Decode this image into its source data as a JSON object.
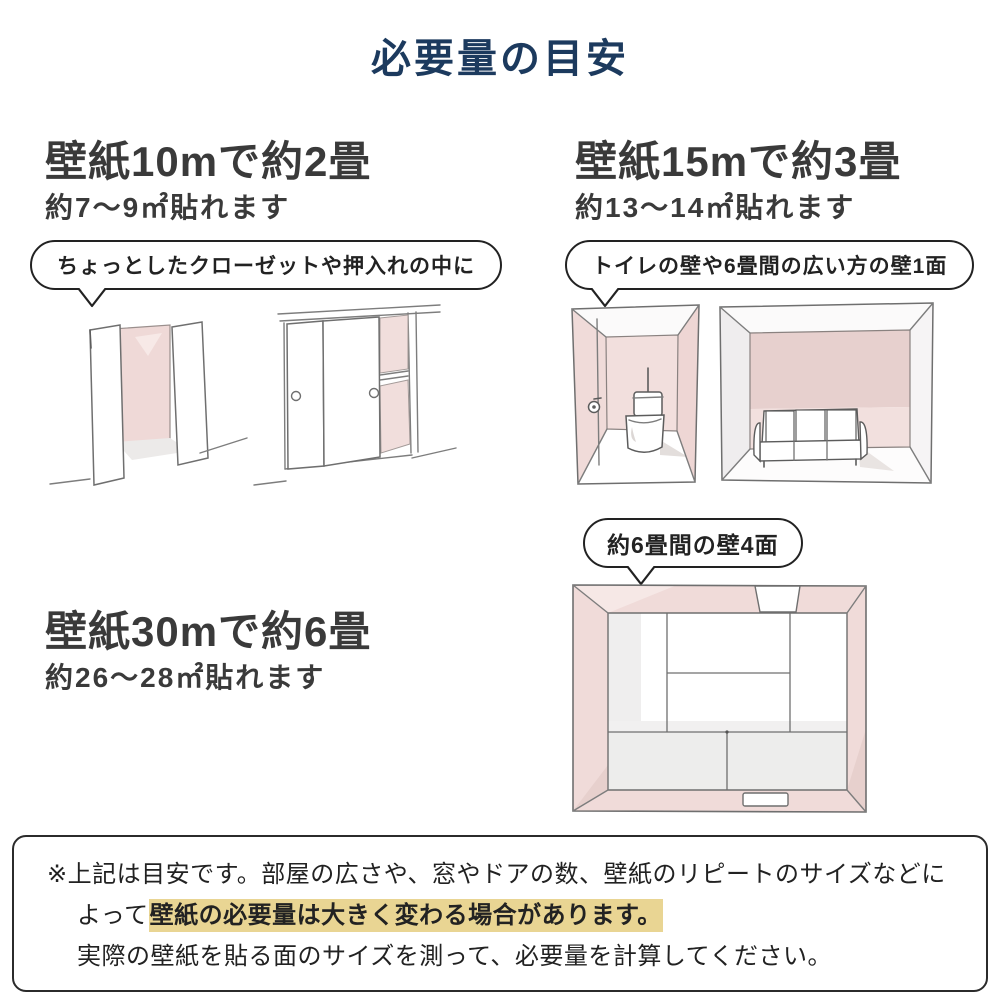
{
  "title": "必要量の目安",
  "sections": {
    "s10": {
      "heading": "壁紙10mで約2畳",
      "subheading": "約7〜9㎡貼れます",
      "bubble": "ちょっとしたクローゼットや押入れの中に",
      "illustrations": [
        "open-closet",
        "sliding-door-closet"
      ]
    },
    "s15": {
      "heading": "壁紙15mで約3畳",
      "subheading": "約13〜14㎡貼れます",
      "bubble": "トイレの壁や6畳間の広い方の壁1面",
      "illustrations": [
        "toilet-room",
        "sofa-room"
      ]
    },
    "s30": {
      "heading": "壁紙30mで約6畳",
      "subheading": "約26〜28㎡貼れます",
      "bubble": "約6畳間の壁4面",
      "illustrations": [
        "six-tatami-room-top-view"
      ]
    }
  },
  "note": {
    "line1": "※上記は目安です。部屋の広さや、窓やドアの数、壁紙のリピートのサイズなどに",
    "line2_prefix": "よって",
    "line2_highlight": "壁紙の必要量は大きく変わる場合があります。",
    "line3": "実際の壁紙を貼る面のサイズを測って、必要量を計算してください。"
  },
  "colors": {
    "title_navy": "#1c3a5e",
    "heading_gray": "#3a3a3a",
    "highlight_tan": "#e9d593",
    "wall_pink": "#f0dbd9",
    "wall_pink_dark": "#e7d0cd",
    "sketch_line": "#7d7d7d"
  }
}
